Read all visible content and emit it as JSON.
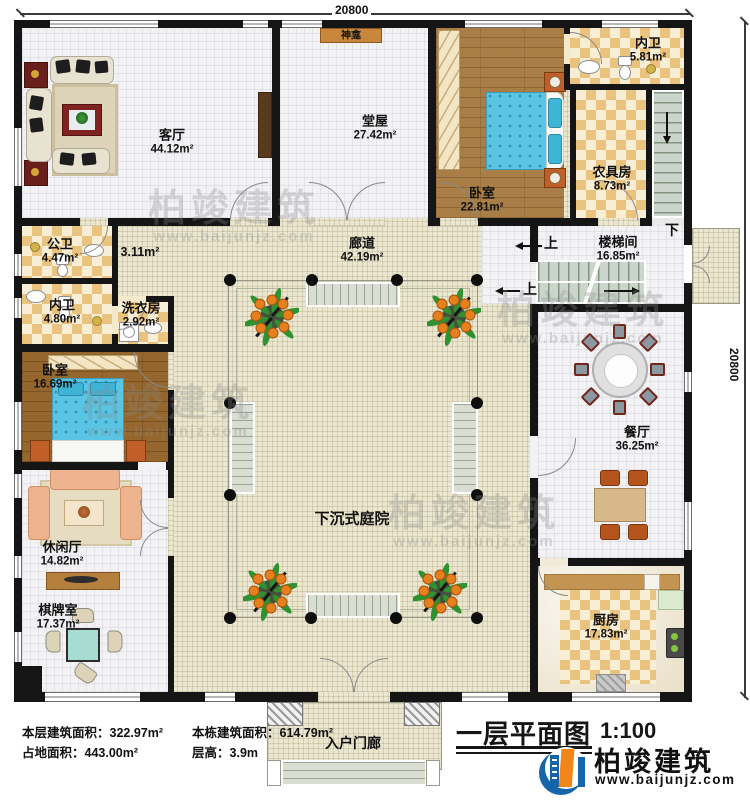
{
  "dimensions": {
    "top": "20800",
    "right": "20800"
  },
  "rooms": {
    "living": {
      "name": "客厅",
      "area": "44.12m²"
    },
    "hall": {
      "name": "堂屋",
      "area": "27.42m²"
    },
    "shrine": {
      "name": "神龛"
    },
    "bedroom_top": {
      "name": "卧室",
      "area": "22.81m²"
    },
    "bath_ensuite_top": {
      "name": "内卫",
      "area": "5.81m²"
    },
    "farm_tool": {
      "name": "农具房",
      "area": "8.73m²"
    },
    "stairwell": {
      "name": "楼梯间",
      "area": "16.85m²"
    },
    "public_bath": {
      "name": "公卫",
      "area": "4.47m²"
    },
    "passage": {
      "area": "3.11m²"
    },
    "bath_ensuite_left": {
      "name": "内卫",
      "area": "4.80m²"
    },
    "laundry": {
      "name": "洗衣房",
      "area": "2.92m²"
    },
    "bedroom_left": {
      "name": "卧室",
      "area": "16.69m²"
    },
    "corridor": {
      "name": "廊道",
      "area": "42.19m²"
    },
    "leisure": {
      "name": "休闲厅",
      "area": "14.82m²"
    },
    "chess": {
      "name": "棋牌室",
      "area": "17.37m²"
    },
    "courtyard": {
      "name": "下沉式庭院"
    },
    "dining": {
      "name": "餐厅",
      "area": "36.25m²"
    },
    "kitchen": {
      "name": "厨房",
      "area": "17.83m²"
    },
    "porch": {
      "name": "入户门廊"
    }
  },
  "stairs": {
    "up": "上",
    "down": "下"
  },
  "footer": {
    "floor_area_label": "本层建筑面积：",
    "floor_area_value": "322.97m²",
    "site_area_label": "占地面积：",
    "site_area_value": "443.00m²",
    "building_area_label": "本栋建筑面积：",
    "building_area_value": "614.79m²",
    "floor_height_label": "层高：",
    "floor_height_value": "3.9m",
    "title": "一层平面图",
    "scale": "1:100"
  },
  "logo": {
    "name": "柏竣建筑",
    "website": "www.baijunjz.com"
  },
  "watermark": {
    "line1": "柏竣建筑",
    "line2": "www.baijunjz.com"
  },
  "colors": {
    "brand_blue": "#1565ab",
    "brand_orange": "#f08519",
    "wall": "#151515"
  }
}
